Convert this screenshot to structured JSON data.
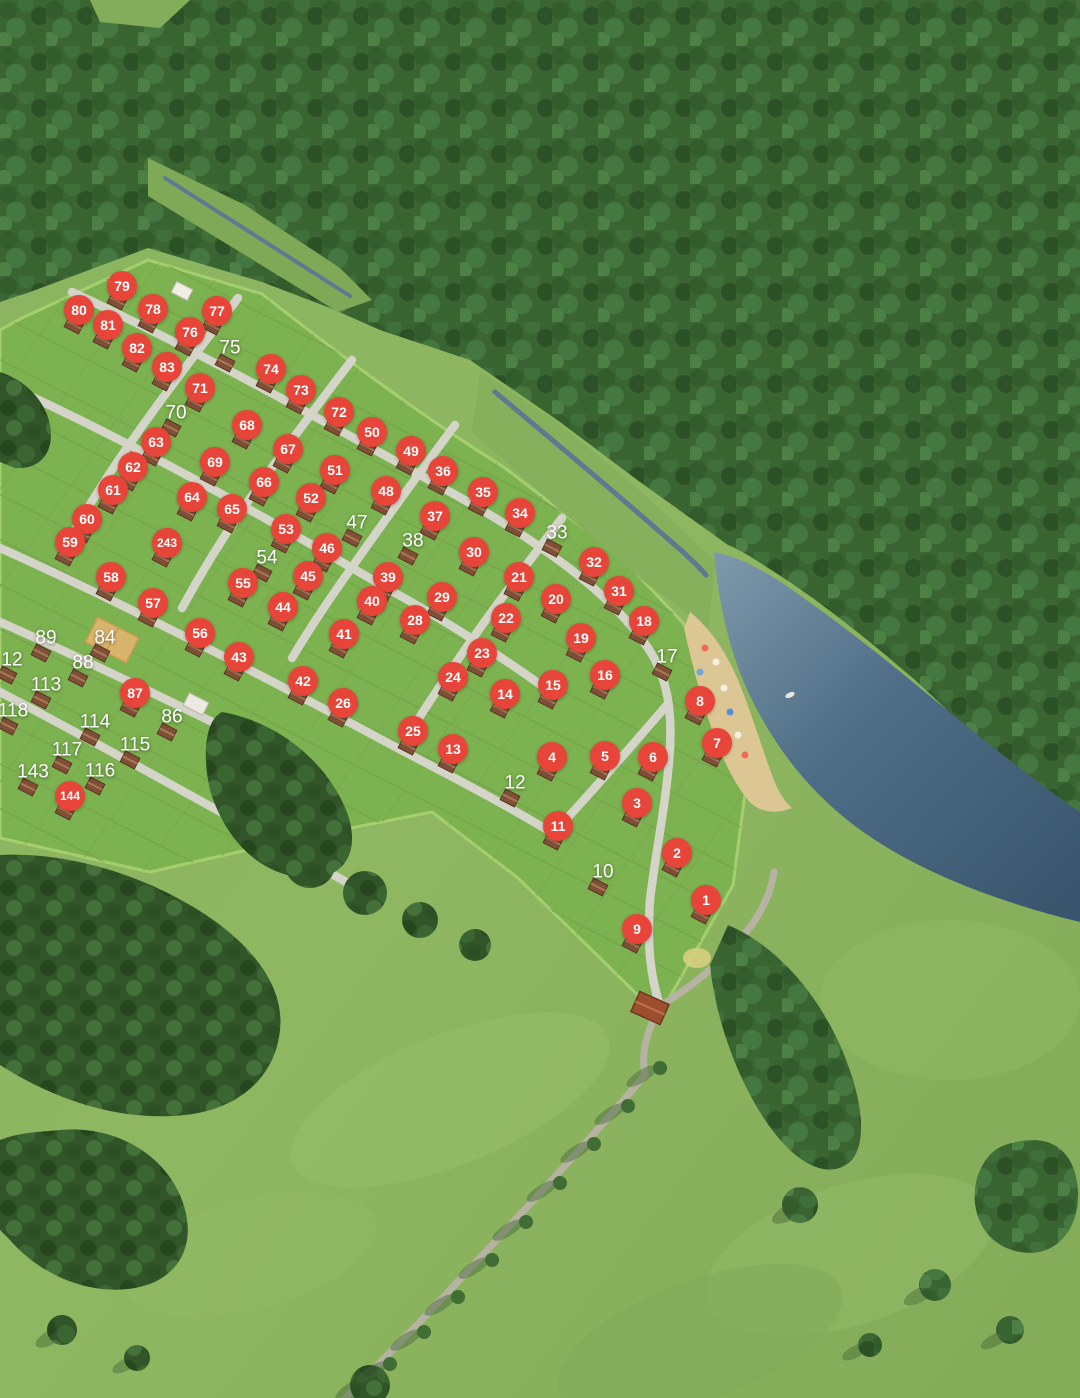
{
  "map": {
    "description": "Aerial 3D masterplan of a cottage village: numbered land lots among forest, a creek, a pond with beach, and an access road",
    "zone_labels": []
  },
  "colors": {
    "pin_bg": "#e8453a",
    "pin_text": "#ffffff",
    "label_text": "#ffffff"
  },
  "lots": {
    "pins": [
      {
        "num": "79",
        "x": 122,
        "y": 286
      },
      {
        "num": "80",
        "x": 79,
        "y": 310
      },
      {
        "num": "78",
        "x": 153,
        "y": 309
      },
      {
        "num": "77",
        "x": 217,
        "y": 311
      },
      {
        "num": "81",
        "x": 108,
        "y": 325
      },
      {
        "num": "76",
        "x": 190,
        "y": 332
      },
      {
        "num": "82",
        "x": 137,
        "y": 348
      },
      {
        "num": "83",
        "x": 167,
        "y": 367
      },
      {
        "num": "74",
        "x": 271,
        "y": 369
      },
      {
        "num": "71",
        "x": 200,
        "y": 388
      },
      {
        "num": "73",
        "x": 301,
        "y": 390
      },
      {
        "num": "72",
        "x": 339,
        "y": 412
      },
      {
        "num": "68",
        "x": 247,
        "y": 425
      },
      {
        "num": "63",
        "x": 156,
        "y": 442
      },
      {
        "num": "67",
        "x": 288,
        "y": 449
      },
      {
        "num": "50",
        "x": 372,
        "y": 432
      },
      {
        "num": "49",
        "x": 411,
        "y": 451
      },
      {
        "num": "69",
        "x": 215,
        "y": 462
      },
      {
        "num": "62",
        "x": 133,
        "y": 467
      },
      {
        "num": "36",
        "x": 443,
        "y": 471
      },
      {
        "num": "51",
        "x": 335,
        "y": 470
      },
      {
        "num": "66",
        "x": 264,
        "y": 482
      },
      {
        "num": "61",
        "x": 113,
        "y": 490
      },
      {
        "num": "64",
        "x": 192,
        "y": 497
      },
      {
        "num": "48",
        "x": 386,
        "y": 491
      },
      {
        "num": "35",
        "x": 483,
        "y": 492
      },
      {
        "num": "52",
        "x": 311,
        "y": 498
      },
      {
        "num": "65",
        "x": 232,
        "y": 509
      },
      {
        "num": "37",
        "x": 435,
        "y": 516
      },
      {
        "num": "60",
        "x": 87,
        "y": 519
      },
      {
        "num": "34",
        "x": 520,
        "y": 513
      },
      {
        "num": "53",
        "x": 286,
        "y": 529
      },
      {
        "num": "59",
        "x": 70,
        "y": 542
      },
      {
        "num": "243",
        "x": 167,
        "y": 543
      },
      {
        "num": "46",
        "x": 327,
        "y": 548
      },
      {
        "num": "30",
        "x": 474,
        "y": 552
      },
      {
        "num": "58",
        "x": 111,
        "y": 577
      },
      {
        "num": "55",
        "x": 243,
        "y": 583
      },
      {
        "num": "45",
        "x": 308,
        "y": 576
      },
      {
        "num": "39",
        "x": 388,
        "y": 577
      },
      {
        "num": "32",
        "x": 594,
        "y": 562
      },
      {
        "num": "21",
        "x": 519,
        "y": 577
      },
      {
        "num": "57",
        "x": 153,
        "y": 603
      },
      {
        "num": "44",
        "x": 283,
        "y": 607
      },
      {
        "num": "40",
        "x": 372,
        "y": 601
      },
      {
        "num": "29",
        "x": 442,
        "y": 597
      },
      {
        "num": "20",
        "x": 556,
        "y": 599
      },
      {
        "num": "31",
        "x": 619,
        "y": 591
      },
      {
        "num": "56",
        "x": 200,
        "y": 633
      },
      {
        "num": "41",
        "x": 344,
        "y": 634
      },
      {
        "num": "28",
        "x": 415,
        "y": 620
      },
      {
        "num": "22",
        "x": 506,
        "y": 618
      },
      {
        "num": "18",
        "x": 644,
        "y": 621
      },
      {
        "num": "43",
        "x": 239,
        "y": 657
      },
      {
        "num": "23",
        "x": 482,
        "y": 653
      },
      {
        "num": "19",
        "x": 581,
        "y": 638
      },
      {
        "num": "87",
        "x": 135,
        "y": 693
      },
      {
        "num": "42",
        "x": 303,
        "y": 681
      },
      {
        "num": "24",
        "x": 453,
        "y": 677
      },
      {
        "num": "14",
        "x": 505,
        "y": 694
      },
      {
        "num": "15",
        "x": 553,
        "y": 685
      },
      {
        "num": "16",
        "x": 605,
        "y": 675
      },
      {
        "num": "8",
        "x": 700,
        "y": 701
      },
      {
        "num": "26",
        "x": 343,
        "y": 703
      },
      {
        "num": "25",
        "x": 413,
        "y": 731
      },
      {
        "num": "13",
        "x": 453,
        "y": 749
      },
      {
        "num": "7",
        "x": 717,
        "y": 743
      },
      {
        "num": "4",
        "x": 552,
        "y": 757
      },
      {
        "num": "5",
        "x": 605,
        "y": 756
      },
      {
        "num": "6",
        "x": 653,
        "y": 757
      },
      {
        "num": "3",
        "x": 637,
        "y": 803
      },
      {
        "num": "11",
        "x": 558,
        "y": 826
      },
      {
        "num": "2",
        "x": 677,
        "y": 853
      },
      {
        "num": "1",
        "x": 706,
        "y": 900
      },
      {
        "num": "9",
        "x": 637,
        "y": 929
      },
      {
        "num": "144",
        "x": 70,
        "y": 796
      }
    ],
    "labels": [
      {
        "num": "75",
        "x": 230,
        "y": 348
      },
      {
        "num": "70",
        "x": 176,
        "y": 413
      },
      {
        "num": "33",
        "x": 557,
        "y": 533
      },
      {
        "num": "47",
        "x": 357,
        "y": 523
      },
      {
        "num": "38",
        "x": 413,
        "y": 541
      },
      {
        "num": "54",
        "x": 267,
        "y": 558
      },
      {
        "num": "89",
        "x": 46,
        "y": 638
      },
      {
        "num": "84",
        "x": 105,
        "y": 638
      },
      {
        "num": "12",
        "x": 12,
        "y": 660
      },
      {
        "num": "88",
        "x": 83,
        "y": 663
      },
      {
        "num": "113",
        "x": 46,
        "y": 685
      },
      {
        "num": "118",
        "x": 13,
        "y": 711
      },
      {
        "num": "86",
        "x": 172,
        "y": 717
      },
      {
        "num": "114",
        "x": 95,
        "y": 722
      },
      {
        "num": "115",
        "x": 135,
        "y": 745
      },
      {
        "num": "117",
        "x": 67,
        "y": 750
      },
      {
        "num": "116",
        "x": 100,
        "y": 771
      },
      {
        "num": "143",
        "x": 33,
        "y": 772
      },
      {
        "num": "17",
        "x": 667,
        "y": 657
      },
      {
        "num": "12",
        "x": 515,
        "y": 783
      },
      {
        "num": "10",
        "x": 603,
        "y": 872
      }
    ]
  }
}
